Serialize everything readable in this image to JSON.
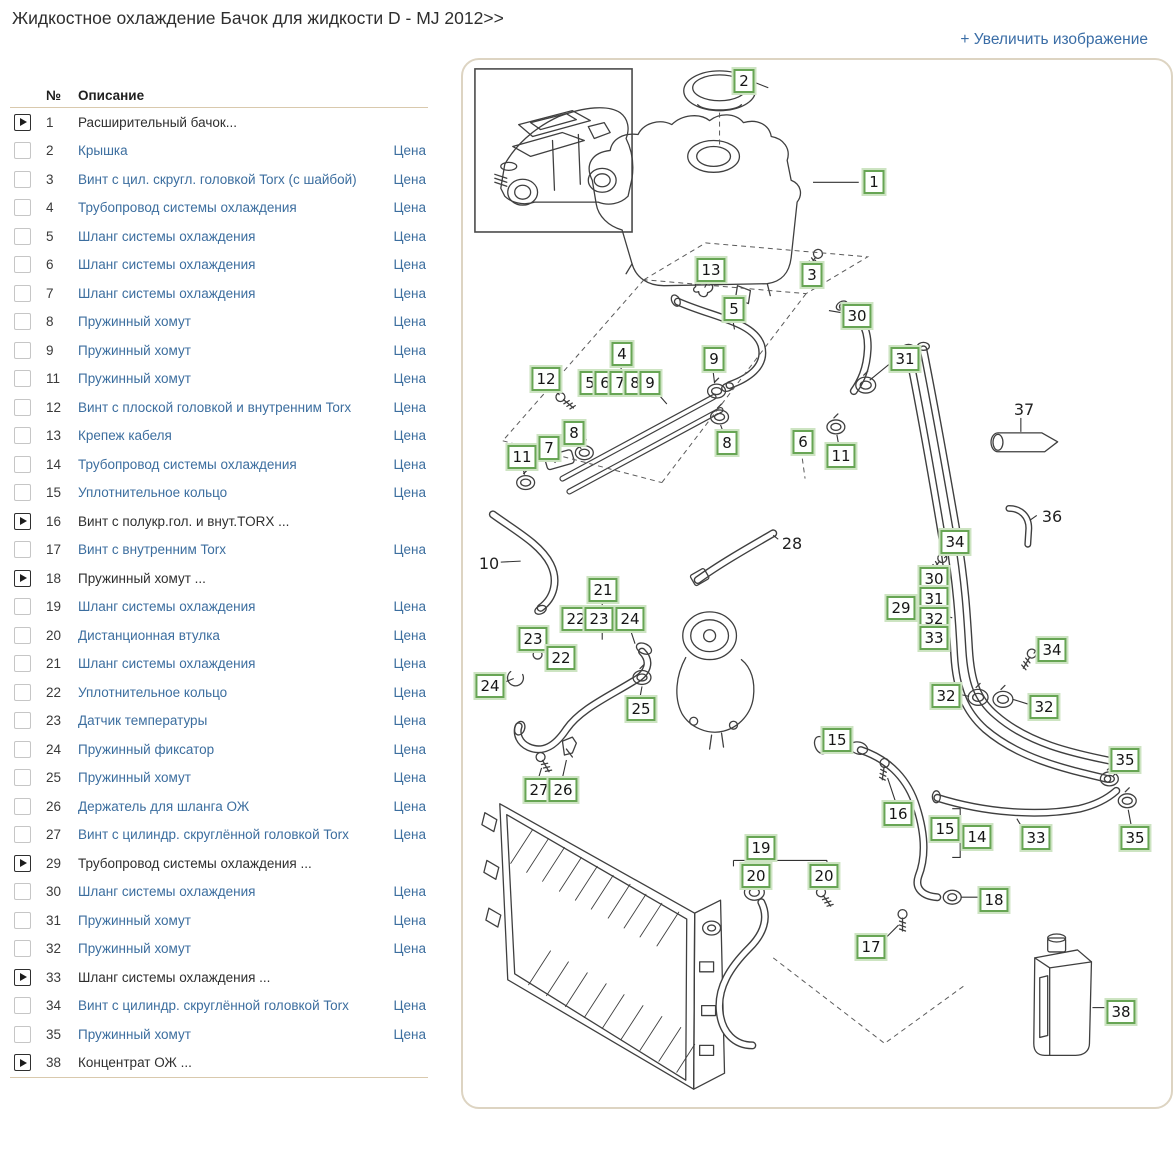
{
  "page": {
    "title": "Жидкостное охлаждение Бачок для жидкости D - MJ 2012>>",
    "enlarge_label": "+ Увеличить изображение"
  },
  "colors": {
    "link": "#3c6e9f",
    "text": "#2f2f2f",
    "callout_green": "#67a554",
    "separator": "#d9c9ad",
    "panel_border": "#ddd4c2"
  },
  "table": {
    "headers": {
      "num": "№",
      "desc": "Описание"
    },
    "price_label": "Цена",
    "rows": [
      {
        "num": "1",
        "desc": "Расширительный бачок...",
        "group": true
      },
      {
        "num": "2",
        "desc": "Крышка"
      },
      {
        "num": "3",
        "desc": "Винт с цил. скругл. головкой Torx (с шайбой)"
      },
      {
        "num": "4",
        "desc": "Трубопровод системы охлаждения"
      },
      {
        "num": "5",
        "desc": "Шланг системы охлаждения"
      },
      {
        "num": "6",
        "desc": "Шланг системы охлаждения"
      },
      {
        "num": "7",
        "desc": "Шланг системы охлаждения"
      },
      {
        "num": "8",
        "desc": "Пружинный хомут"
      },
      {
        "num": "9",
        "desc": "Пружинный хомут"
      },
      {
        "num": "11",
        "desc": "Пружинный хомут"
      },
      {
        "num": "12",
        "desc": "Винт с плоской головкой и внутренним Torx"
      },
      {
        "num": "13",
        "desc": "Крепеж кабеля"
      },
      {
        "num": "14",
        "desc": "Трубопровод системы охлаждения"
      },
      {
        "num": "15",
        "desc": "Уплотнительное кольцо"
      },
      {
        "num": "16",
        "desc": "Винт с полукр.гол. и внут.TORX ...",
        "group": true
      },
      {
        "num": "17",
        "desc": "Винт с внутренним Torx"
      },
      {
        "num": "18",
        "desc": "Пружинный хомут ...",
        "group": true
      },
      {
        "num": "19",
        "desc": "Шланг системы охлаждения"
      },
      {
        "num": "20",
        "desc": "Дистанционная втулка"
      },
      {
        "num": "21",
        "desc": "Шланг системы охлаждения"
      },
      {
        "num": "22",
        "desc": "Уплотнительное кольцо"
      },
      {
        "num": "23",
        "desc": "Датчик температуры"
      },
      {
        "num": "24",
        "desc": "Пружинный фиксатор"
      },
      {
        "num": "25",
        "desc": "Пружинный хомут"
      },
      {
        "num": "26",
        "desc": "Держатель для шланга ОЖ"
      },
      {
        "num": "27",
        "desc": "Винт с цилиндр. скруглённой головкой Torx"
      },
      {
        "num": "29",
        "desc": "Трубопровод системы охлаждения ...",
        "group": true
      },
      {
        "num": "30",
        "desc": "Шланг системы охлаждения"
      },
      {
        "num": "31",
        "desc": "Пружинный хомут"
      },
      {
        "num": "32",
        "desc": "Пружинный хомут"
      },
      {
        "num": "33",
        "desc": "Шланг системы охлаждения ...",
        "group": true
      },
      {
        "num": "34",
        "desc": "Винт с цилиндр. скруглённой головкой Torx"
      },
      {
        "num": "35",
        "desc": "Пружинный хомут"
      },
      {
        "num": "38",
        "desc": "Концентрат ОЖ ...",
        "group": true
      }
    ]
  },
  "diagram": {
    "callouts": [
      {
        "label": "2",
        "x": 281,
        "y": 21
      },
      {
        "label": "1",
        "x": 411,
        "y": 122
      },
      {
        "label": "13",
        "x": 248,
        "y": 210
      },
      {
        "label": "3",
        "x": 349,
        "y": 215
      },
      {
        "label": "5",
        "x": 271,
        "y": 249
      },
      {
        "label": "30",
        "x": 394,
        "y": 256
      },
      {
        "label": "4",
        "x": 159,
        "y": 294
      },
      {
        "label": "9",
        "x": 251,
        "y": 299
      },
      {
        "label": "31",
        "x": 442,
        "y": 299
      },
      {
        "label": "12",
        "x": 83,
        "y": 319
      },
      {
        "label": "5",
        "x": 127,
        "y": 323
      },
      {
        "label": "6",
        "x": 142,
        "y": 323
      },
      {
        "label": "7",
        "x": 157,
        "y": 323
      },
      {
        "label": "8",
        "x": 172,
        "y": 323
      },
      {
        "label": "9",
        "x": 187,
        "y": 323
      },
      {
        "label": "37",
        "x": 561,
        "y": 350,
        "boxed": false
      },
      {
        "label": "8",
        "x": 111,
        "y": 373
      },
      {
        "label": "6",
        "x": 340,
        "y": 382
      },
      {
        "label": "8",
        "x": 264,
        "y": 383
      },
      {
        "label": "7",
        "x": 86,
        "y": 388
      },
      {
        "label": "11",
        "x": 59,
        "y": 397
      },
      {
        "label": "11",
        "x": 378,
        "y": 396
      },
      {
        "label": "36",
        "x": 589,
        "y": 457,
        "boxed": false
      },
      {
        "label": "34",
        "x": 492,
        "y": 482
      },
      {
        "label": "28",
        "x": 329,
        "y": 484,
        "boxed": false
      },
      {
        "label": "10",
        "x": 26,
        "y": 504,
        "boxed": false
      },
      {
        "label": "30",
        "x": 471,
        "y": 519
      },
      {
        "label": "21",
        "x": 140,
        "y": 530
      },
      {
        "label": "31",
        "x": 471,
        "y": 539
      },
      {
        "label": "29",
        "x": 438,
        "y": 548
      },
      {
        "label": "22",
        "x": 113,
        "y": 559
      },
      {
        "label": "23",
        "x": 136,
        "y": 559
      },
      {
        "label": "24",
        "x": 167,
        "y": 559
      },
      {
        "label": "32",
        "x": 471,
        "y": 559
      },
      {
        "label": "33",
        "x": 471,
        "y": 578
      },
      {
        "label": "23",
        "x": 70,
        "y": 579
      },
      {
        "label": "34",
        "x": 589,
        "y": 590
      },
      {
        "label": "22",
        "x": 98,
        "y": 598
      },
      {
        "label": "24",
        "x": 27,
        "y": 626
      },
      {
        "label": "32",
        "x": 483,
        "y": 636
      },
      {
        "label": "32",
        "x": 581,
        "y": 647
      },
      {
        "label": "25",
        "x": 178,
        "y": 649
      },
      {
        "label": "15",
        "x": 374,
        "y": 680
      },
      {
        "label": "35",
        "x": 662,
        "y": 700
      },
      {
        "label": "27",
        "x": 76,
        "y": 730
      },
      {
        "label": "26",
        "x": 100,
        "y": 730
      },
      {
        "label": "16",
        "x": 435,
        "y": 754
      },
      {
        "label": "15",
        "x": 482,
        "y": 769
      },
      {
        "label": "14",
        "x": 514,
        "y": 777
      },
      {
        "label": "33",
        "x": 573,
        "y": 778
      },
      {
        "label": "35",
        "x": 672,
        "y": 778
      },
      {
        "label": "19",
        "x": 298,
        "y": 788
      },
      {
        "label": "20",
        "x": 293,
        "y": 816
      },
      {
        "label": "20",
        "x": 361,
        "y": 816
      },
      {
        "label": "18",
        "x": 531,
        "y": 840
      },
      {
        "label": "17",
        "x": 408,
        "y": 887
      },
      {
        "label": "38",
        "x": 658,
        "y": 952
      }
    ]
  }
}
